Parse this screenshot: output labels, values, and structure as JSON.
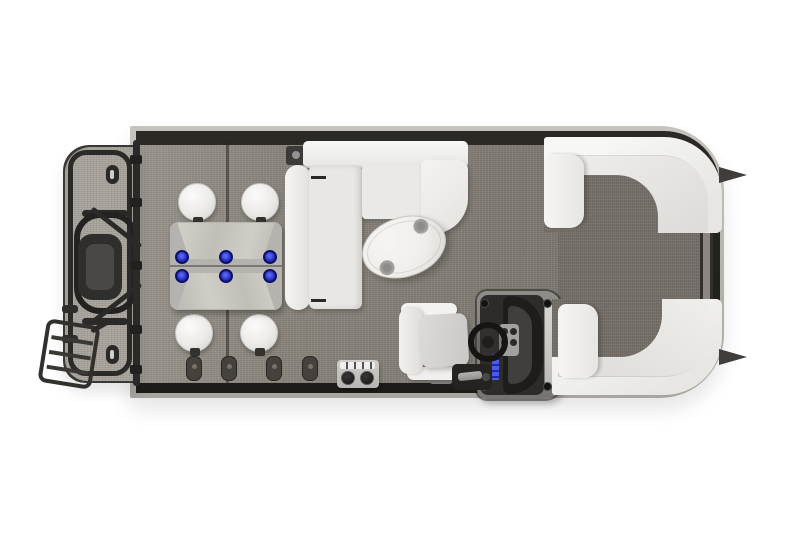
{
  "scene": {
    "subject": "pontoon-boat-floorplan-top-view",
    "orientation": "bow-right",
    "visible_text": "none"
  },
  "colors": {
    "background": "#ffffff",
    "deck_edge": "#26241f",
    "main_carpet": "#8a857d",
    "walkway_carpet": "#76706a",
    "platform_carpet": "#a49f98",
    "trim": "#b5b2ad",
    "rail": "#2b2a28",
    "upholstery": "#f4f3f1",
    "upholstery_shade": "#e0dfdc",
    "lounger_body": "#b5b3af",
    "lounger_cushion": "#cbc9c3",
    "accent_blue": "#2a33c9",
    "console_dark": "#2d2c2a",
    "console_frame": "#8f8d89",
    "table_white": "#efeeeb",
    "hardware_dark": "#24231f"
  },
  "inventory": {
    "stern": [
      "swim-platform",
      "outboard-motor",
      "motor-guard-loop",
      "boarding-ladder",
      "stern-fence-rail",
      "cleats"
    ],
    "midship": [
      "pedestal-stools",
      "back-to-back-lounger",
      "blue-cupholders",
      "l-shaped-sofa",
      "oval-table",
      "deck-accessory-box"
    ],
    "helm": [
      "captains-chair",
      "helm-console",
      "steering-wheel",
      "gauge-panel",
      "switch-panel"
    ],
    "bow": [
      "port-bow-couch",
      "starboard-bow-couch",
      "bow-walkway",
      "bow-gate",
      "nose-cones"
    ]
  },
  "counts": {
    "pedestal_stools": 4,
    "blue_cupholders": 6,
    "table_cupholders": 2,
    "rail_mount_pads": 4,
    "fence_clamps": 5,
    "console_bolts": 4,
    "ladder_rungs": 3,
    "nose_cones": 2
  }
}
